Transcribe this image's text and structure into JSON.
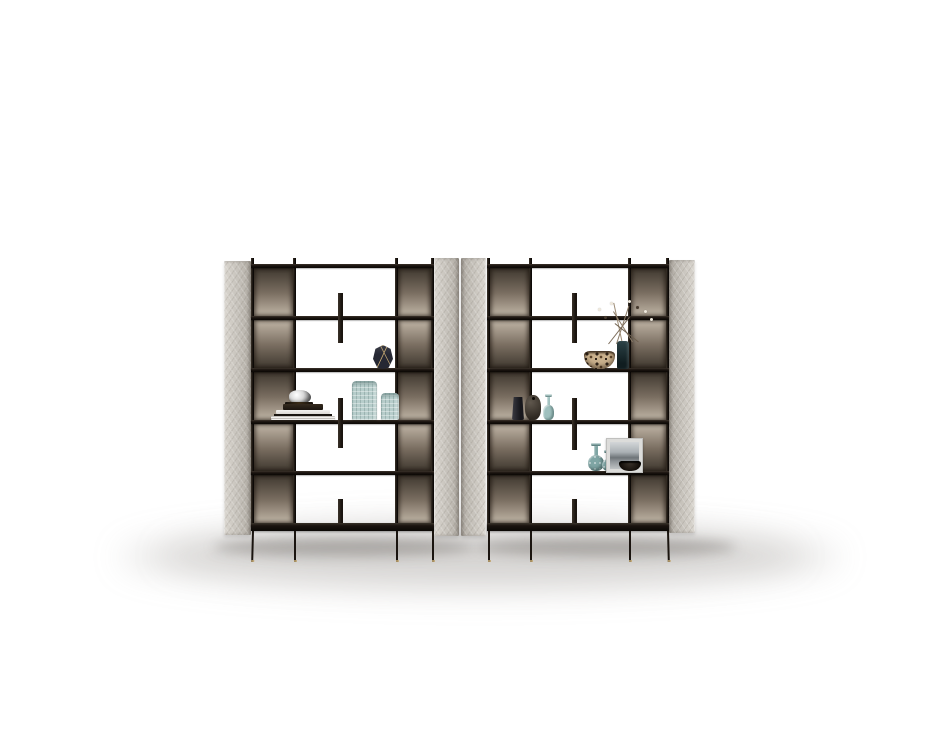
{
  "scene": {
    "type": "product-photo",
    "subject": "Two freestanding open bookshelf units with upholstered gray side panels, smoked-bronze back panels, black metal frames and decorative objects on a white studio background",
    "background": "#ffffff"
  },
  "palette": {
    "bg": "#ffffff",
    "panel": "#c9c5be",
    "panel_hi": "#dad6cf",
    "panel_lo": "#b2ada5",
    "frame_dark": "#1a140f",
    "frame_mid": "#3b332a",
    "bronze_dark": "#3f382f",
    "bronze_mid": "#7a6e61",
    "bronze_light": "#c0b5a6",
    "gold": "#bfa471",
    "silver": "#d9d9d9",
    "teal_glass": "#b7cdcb",
    "teal_glass2": "#9fc0be",
    "teal_deep": "#7fa5a4",
    "leopard_base": "#c9b08c",
    "leopard_spot": "#30241a",
    "frame_gray": "#dcdcda",
    "shadow_core": "rgba(95,90,84,0.38)",
    "shadow_soft": "rgba(140,136,130,0.20)"
  },
  "units": [
    {
      "name": "left bookshelf unit",
      "shelf_rows": 5,
      "side_panels": 2,
      "divider_fins": 3,
      "legs": 4,
      "items": [
        {
          "label": "faceted geometric vase",
          "color": "#262833"
        },
        {
          "label": "silver knot ornament",
          "color": "#d9d9d9"
        },
        {
          "label": "stack of books",
          "color": "#f1efec"
        },
        {
          "label": "ribbed celadon vase (large)",
          "color": "#b7cdcb"
        },
        {
          "label": "ribbed celadon vase (small)",
          "color": "#b7cdcb"
        }
      ]
    },
    {
      "name": "right bookshelf unit",
      "shelf_rows": 5,
      "side_panels": 2,
      "divider_fins": 3,
      "legs": 4,
      "items": [
        {
          "label": "speckled ceramic bowl",
          "color": "#c9b08c"
        },
        {
          "label": "dark vase with dried branches",
          "color": "#22363a"
        },
        {
          "label": "charcoal slim vase",
          "color": "#2e2e34"
        },
        {
          "label": "charcoal pebble vase",
          "color": "#3c352d"
        },
        {
          "label": "teal glass bottle",
          "color": "#9fc0be"
        },
        {
          "label": "teal gourd vase (large)",
          "color": "#7fa5a4"
        },
        {
          "label": "teal gourd vase (small)",
          "color": "#7fa5a4"
        },
        {
          "label": "framed photograph",
          "color": "#dcdcda"
        },
        {
          "label": "black bowl",
          "color": "#16100b"
        }
      ]
    }
  ]
}
